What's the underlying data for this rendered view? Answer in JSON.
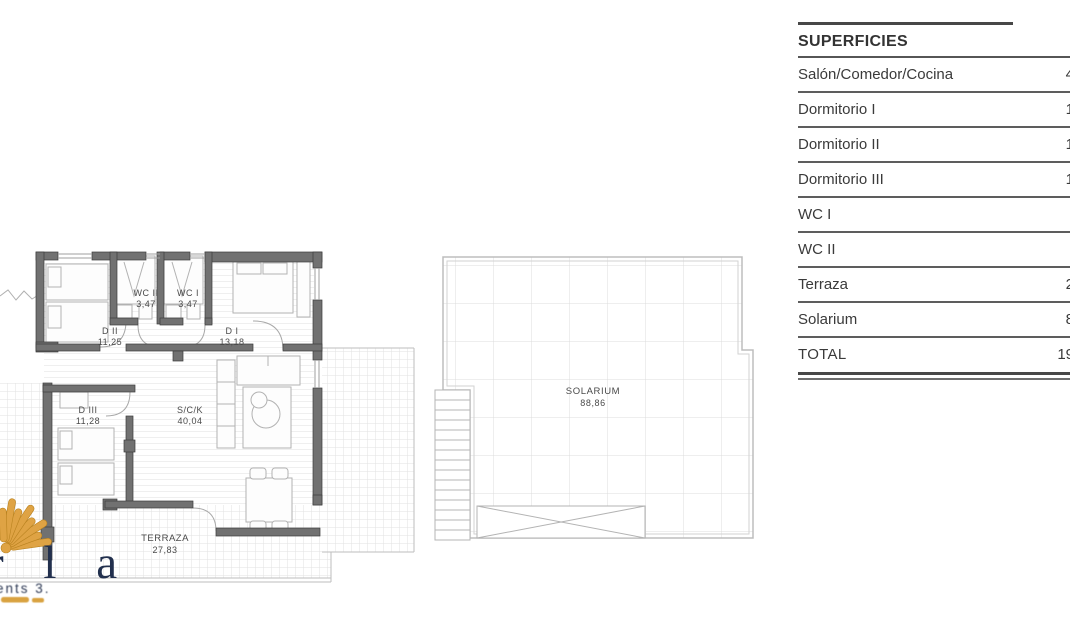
{
  "table": {
    "title": "SUPERFICIES",
    "rows": [
      {
        "label": "Salón/Comedor/Cocina",
        "value_visible": "4"
      },
      {
        "label": "Dormitorio I",
        "value_visible": "1"
      },
      {
        "label": "Dormitorio II",
        "value_visible": "1"
      },
      {
        "label": "Dormitorio III",
        "value_visible": "1"
      },
      {
        "label": "WC I",
        "value_visible": ""
      },
      {
        "label": "WC II",
        "value_visible": ""
      },
      {
        "label": "Terraza",
        "value_visible": "2"
      },
      {
        "label": "Solarium",
        "value_visible": "8"
      },
      {
        "label": "TOTAL",
        "value_visible": "19"
      }
    ]
  },
  "floor_plan": {
    "rooms": [
      {
        "label": "D II",
        "area": "11,25"
      },
      {
        "label": "WC II",
        "area": "3,47"
      },
      {
        "label": "WC I",
        "area": "3,47"
      },
      {
        "label": "D I",
        "area": "13,18"
      },
      {
        "label": "D III",
        "area": "11,28"
      },
      {
        "label": "S/C/K",
        "area": "40,04"
      },
      {
        "label": "TERRAZA",
        "area": "27,83"
      },
      {
        "label": "SOLARIUM",
        "area": "88,86"
      }
    ]
  },
  "logo": {
    "wordmark_fragment": "r l a",
    "tagline_fragment": "ents 3.",
    "shell_color": "#dfa344",
    "text_color": "#22304e"
  },
  "colors": {
    "wall": "#717171",
    "wall_edge": "#3c3c3c",
    "thin_line": "#b7b7b7",
    "tile_line": "#e2e2e2",
    "label_text": "#4a4a4a",
    "table_rule": "#5d5d5d"
  }
}
